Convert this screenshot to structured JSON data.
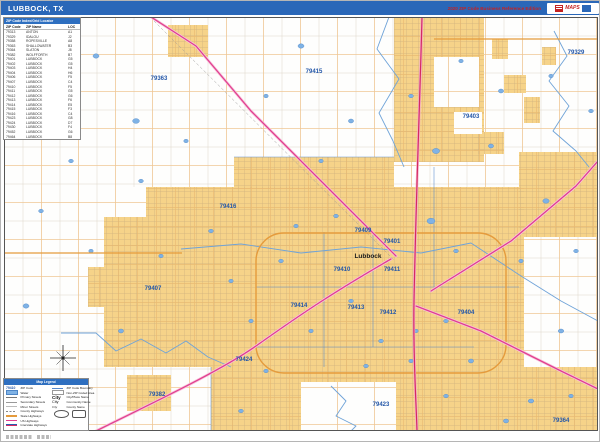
{
  "header": {
    "title": "LUBBOCK, TX",
    "edition": "2020 ZIP Code Business Reference Edition",
    "logo_text": "MAPS"
  },
  "index_table": {
    "title": "ZIP Code Index/Grid Locator",
    "columns": [
      "ZIP Code",
      "ZIP Name",
      "LOC"
    ],
    "rows": [
      [
        "79313",
        "ANTON",
        "A1"
      ],
      [
        "79329",
        "IDALOU",
        "J2"
      ],
      [
        "79358",
        "ROPESVILLE",
        "A8"
      ],
      [
        "79363",
        "SHALLOWATER",
        "B3"
      ],
      [
        "79364",
        "SLATON",
        "J8"
      ],
      [
        "79382",
        "WOLFFORTH",
        "B7"
      ],
      [
        "79401",
        "LUBBOCK",
        "G5"
      ],
      [
        "79402",
        "LUBBOCK",
        "G5"
      ],
      [
        "79403",
        "LUBBOCK",
        "H4"
      ],
      [
        "79404",
        "LUBBOCK",
        "H6"
      ],
      [
        "79406",
        "LUBBOCK",
        "F5"
      ],
      [
        "79407",
        "LUBBOCK",
        "C4"
      ],
      [
        "79410",
        "LUBBOCK",
        "F5"
      ],
      [
        "79411",
        "LUBBOCK",
        "G5"
      ],
      [
        "79412",
        "LUBBOCK",
        "G6"
      ],
      [
        "79413",
        "LUBBOCK",
        "F6"
      ],
      [
        "79414",
        "LUBBOCK",
        "E5"
      ],
      [
        "79415",
        "LUBBOCK",
        "F3"
      ],
      [
        "79416",
        "LUBBOCK",
        "C4"
      ],
      [
        "79423",
        "LUBBOCK",
        "G8"
      ],
      [
        "79424",
        "LUBBOCK",
        "D7"
      ],
      [
        "79430",
        "LUBBOCK",
        "F4"
      ],
      [
        "79452",
        "LUBBOCK",
        "G6"
      ],
      [
        "79464",
        "LUBBOCK",
        "B8"
      ]
    ]
  },
  "legend": {
    "title": "Map Legend",
    "zip_sample": "79410",
    "city_sample": "City",
    "left_items": [
      {
        "label": "ZIP Code",
        "swatch": "zip-text"
      },
      {
        "label": "Water",
        "swatch": "water"
      },
      {
        "label": "Primary Streets",
        "swatch": "line-st1"
      },
      {
        "label": "Secondary Streets",
        "swatch": "line-st2"
      },
      {
        "label": "Minor Streets",
        "swatch": "line-st3"
      },
      {
        "label": "County Highways",
        "swatch": "line-dash"
      },
      {
        "label": "State Highways",
        "swatch": "line-orange"
      },
      {
        "label": "US Highways",
        "swatch": "line-magenta"
      },
      {
        "label": "Interstate Highways",
        "swatch": "line-interstate"
      }
    ],
    "right_items": [
      {
        "label": "ZIP Code Boundary",
        "swatch": "line-blue"
      },
      {
        "label": "Non-ZIP Coded Area",
        "swatch": "rect-white"
      },
      {
        "label": "City/Place Name",
        "swatch": "city-lg"
      },
      {
        "label": "Community Name",
        "swatch": "city-md"
      },
      {
        "label": "County Name",
        "swatch": "city-sm"
      }
    ]
  },
  "map": {
    "city_label": {
      "text": "Lubbock",
      "x": 364,
      "y": 241
    },
    "zip_labels": [
      {
        "text": "79363",
        "x": 155,
        "y": 63
      },
      {
        "text": "79415",
        "x": 310,
        "y": 56
      },
      {
        "text": "79403",
        "x": 467,
        "y": 101
      },
      {
        "text": "79329",
        "x": 572,
        "y": 37
      },
      {
        "text": "79416",
        "x": 224,
        "y": 191
      },
      {
        "text": "79409",
        "x": 359,
        "y": 215
      },
      {
        "text": "79401",
        "x": 388,
        "y": 226
      },
      {
        "text": "79410",
        "x": 338,
        "y": 254
      },
      {
        "text": "79411",
        "x": 388,
        "y": 254
      },
      {
        "text": "79407",
        "x": 149,
        "y": 273
      },
      {
        "text": "79414",
        "x": 295,
        "y": 290
      },
      {
        "text": "79413",
        "x": 352,
        "y": 292
      },
      {
        "text": "79412",
        "x": 384,
        "y": 297
      },
      {
        "text": "79404",
        "x": 462,
        "y": 297
      },
      {
        "text": "79424",
        "x": 240,
        "y": 344
      },
      {
        "text": "79382",
        "x": 153,
        "y": 379
      },
      {
        "text": "79423",
        "x": 377,
        "y": 389
      },
      {
        "text": "79364",
        "x": 557,
        "y": 405
      }
    ]
  },
  "colors": {
    "header_blue": "#2A67B8",
    "city_yellow": "#F6D389",
    "water_blue": "#7FB2E5",
    "us_highway_magenta": "#E0408F",
    "interstate_red": "#D42A63",
    "state_highway_orange": "#E59B3C",
    "zip_label_blue": "#2457A8"
  }
}
